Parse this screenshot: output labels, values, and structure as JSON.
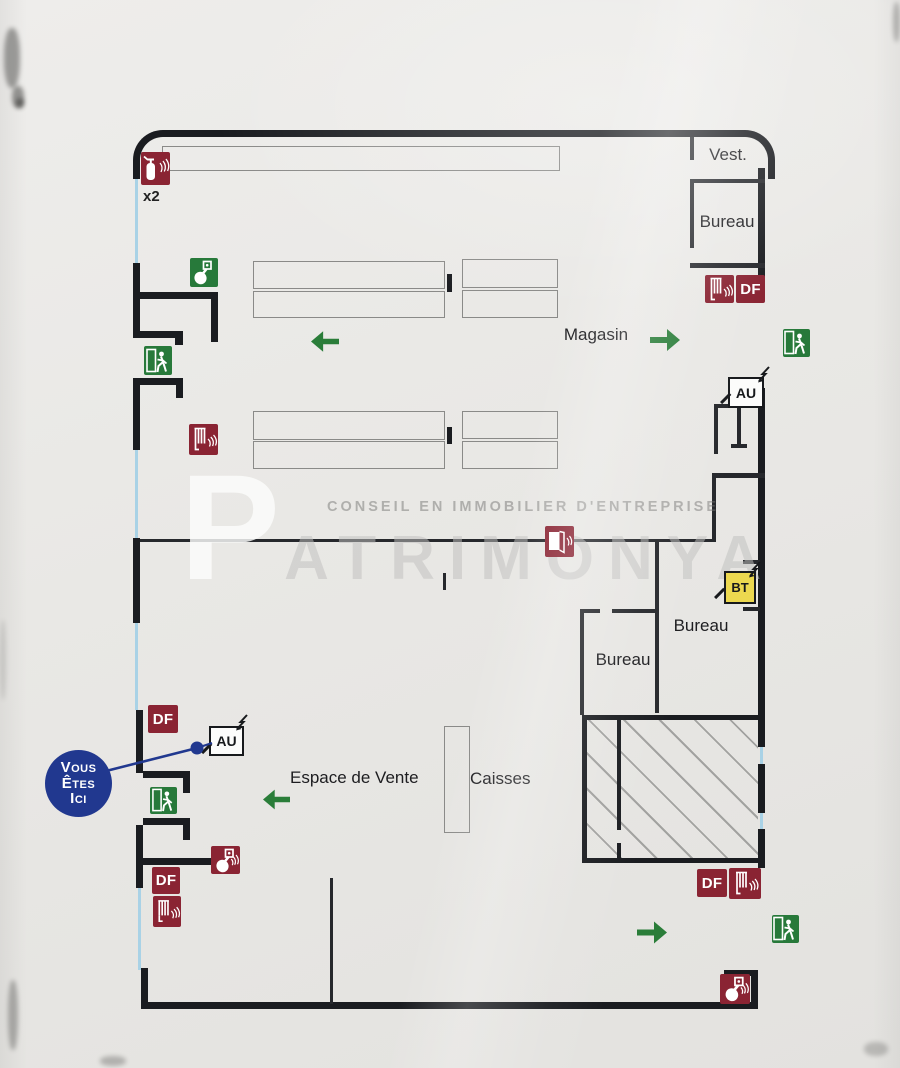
{
  "labels": {
    "vest": "Vest.",
    "bureau": "Bureau",
    "magasin": "Magasin",
    "espace_de_vente": "Espace de Vente",
    "caisses": "Caisses",
    "extinguisher_count": "x2"
  },
  "markers": {
    "df": "DF",
    "au": "AU",
    "bt": "BT"
  },
  "you_are_here": {
    "lines": [
      "Vous",
      "Êtes",
      "Ici"
    ]
  },
  "watermark": {
    "tagline": "CONSEIL EN IMMOBILIER D'ENTREPRISE",
    "brand": "PATRIMONYA"
  },
  "colors": {
    "wall": "#1a1c20",
    "window_line": "#a9d2e6",
    "safety_red": "#8a2433",
    "safety_green": "#27793a",
    "you_are_here_blue": "#21388f",
    "bt_yellow": "#ecd84f"
  }
}
